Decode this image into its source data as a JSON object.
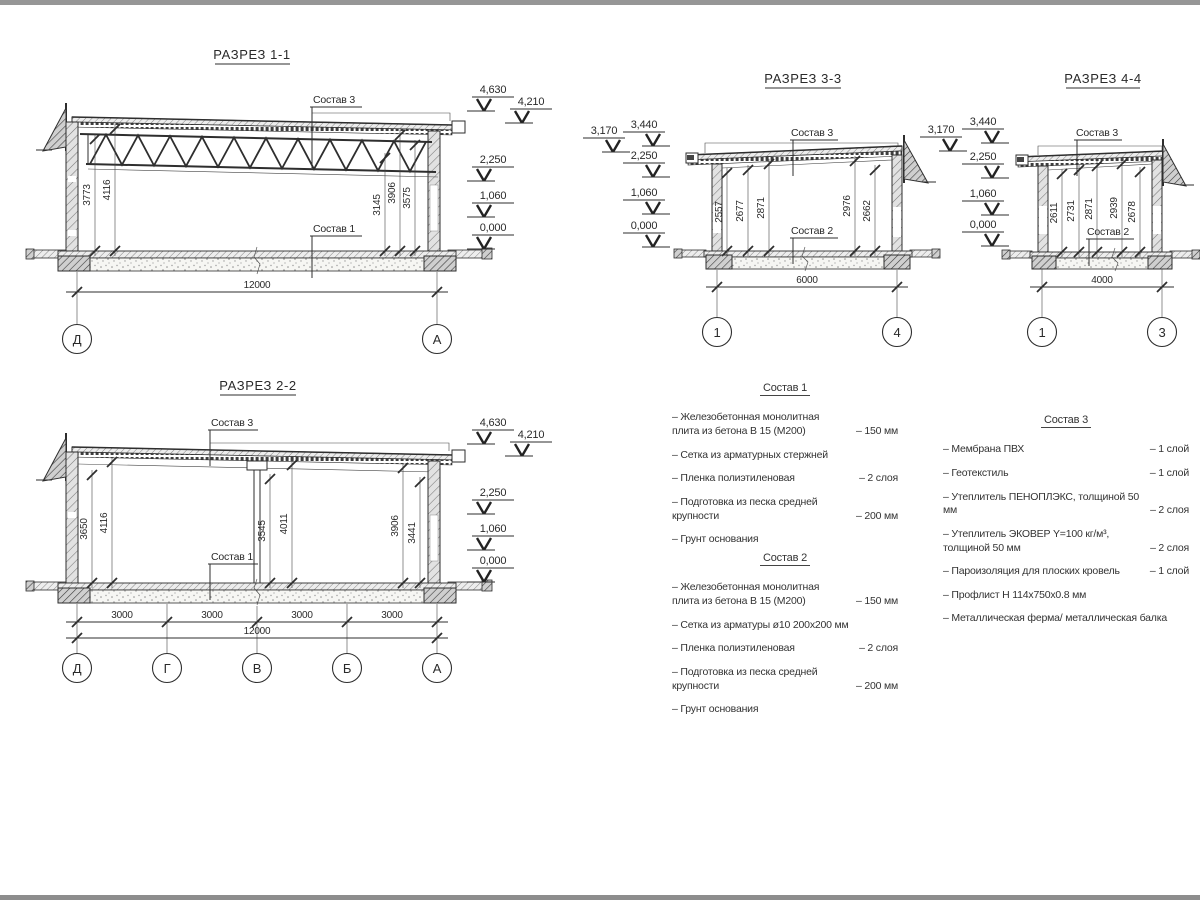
{
  "page": {
    "paper_color": "#ffffff",
    "top_bar_color": "#969696",
    "bottom_bar_color": "#8d8d8d",
    "line_color": "#2e2e2e"
  },
  "sections": {
    "s1": {
      "title": "РАЗРЕЗ 1-1",
      "top_label": "Состав 3",
      "bottom_label": "Состав 1",
      "dims": [
        "3773",
        "4116",
        "3145",
        "3906",
        "3575"
      ],
      "overall": "12000",
      "axes": [
        "Д",
        "А"
      ],
      "elev": [
        "4,630",
        "4,210",
        "2,250",
        "1,060",
        "0,000"
      ]
    },
    "s2": {
      "title": "РАЗРЕЗ 2-2",
      "top_label": "Состав 3",
      "bottom_label": "Состав 1",
      "dims": [
        "3650",
        "4116",
        "3545",
        "4011",
        "3906",
        "3441"
      ],
      "spans": [
        "3000",
        "3000",
        "3000",
        "3000"
      ],
      "overall": "12000",
      "axes": [
        "Д",
        "Г",
        "В",
        "Б",
        "А"
      ],
      "elev": [
        "4,630",
        "4,210",
        "2,250",
        "1,060",
        "0,000"
      ]
    },
    "s3": {
      "title": "РАЗРЕЗ 3-3",
      "top_label": "Состав 3",
      "bottom_label": "Состав 2",
      "dims": [
        "2557",
        "2677",
        "2871",
        "2976",
        "2662"
      ],
      "overall": "6000",
      "axes": [
        "1",
        "4"
      ],
      "elev": [
        "3,170",
        "3,440",
        "2,250",
        "1,060",
        "0,000"
      ]
    },
    "s4": {
      "title": "РАЗРЕЗ 4-4",
      "top_label": "Состав 3",
      "bottom_label": "Состав 2",
      "dims": [
        "2611",
        "2731",
        "2871",
        "2939",
        "2678"
      ],
      "overall": "4000",
      "axes": [
        "1",
        "3"
      ],
      "elev": [
        "3,170",
        "3,440",
        "2,250",
        "1,060",
        "0,000"
      ]
    }
  },
  "compositions": [
    {
      "title": "Состав 1",
      "items": [
        {
          "text": "– Железобетонная монолитная плита из бетона В 15 (М200)",
          "value": "– 150 мм"
        },
        {
          "text": "– Сетка из арматурных стержней",
          "value": ""
        },
        {
          "text": "– Пленка полиэтиленовая",
          "value": "– 2 слоя"
        },
        {
          "text": "– Подготовка из песка средней крупности",
          "value": "– 200 мм"
        },
        {
          "text": "– Грунт основания",
          "value": ""
        }
      ]
    },
    {
      "title": "Состав 2",
      "items": [
        {
          "text": "– Железобетонная монолитная плита из бетона В 15 (М200)",
          "value": "– 150 мм"
        },
        {
          "text": "– Сетка из арматуры ø10 200х200 мм",
          "value": ""
        },
        {
          "text": "– Пленка полиэтиленовая",
          "value": "– 2 слоя"
        },
        {
          "text": "– Подготовка из песка средней крупности",
          "value": "– 200 мм"
        },
        {
          "text": "– Грунт основания",
          "value": ""
        }
      ]
    },
    {
      "title": "Состав 3",
      "items": [
        {
          "text": "– Мембрана ПВХ",
          "value": "– 1 слой"
        },
        {
          "text": "– Геотекстиль",
          "value": "– 1 слой"
        },
        {
          "text": "– Утеплитель ПЕНОПЛЭКС, толщиной 50 мм",
          "value": "– 2 слоя"
        },
        {
          "text": "– Утеплитель ЭКОВЕР Y=100 кг/м³, толщиной 50 мм",
          "value": "– 2 слоя"
        },
        {
          "text": "– Пароизоляция для плоских кровель",
          "value": "– 1 слой"
        },
        {
          "text": "– Профлист Н 114х750х0.8 мм",
          "value": ""
        },
        {
          "text": "– Металлическая ферма/ металлическая балка",
          "value": ""
        }
      ]
    }
  ]
}
